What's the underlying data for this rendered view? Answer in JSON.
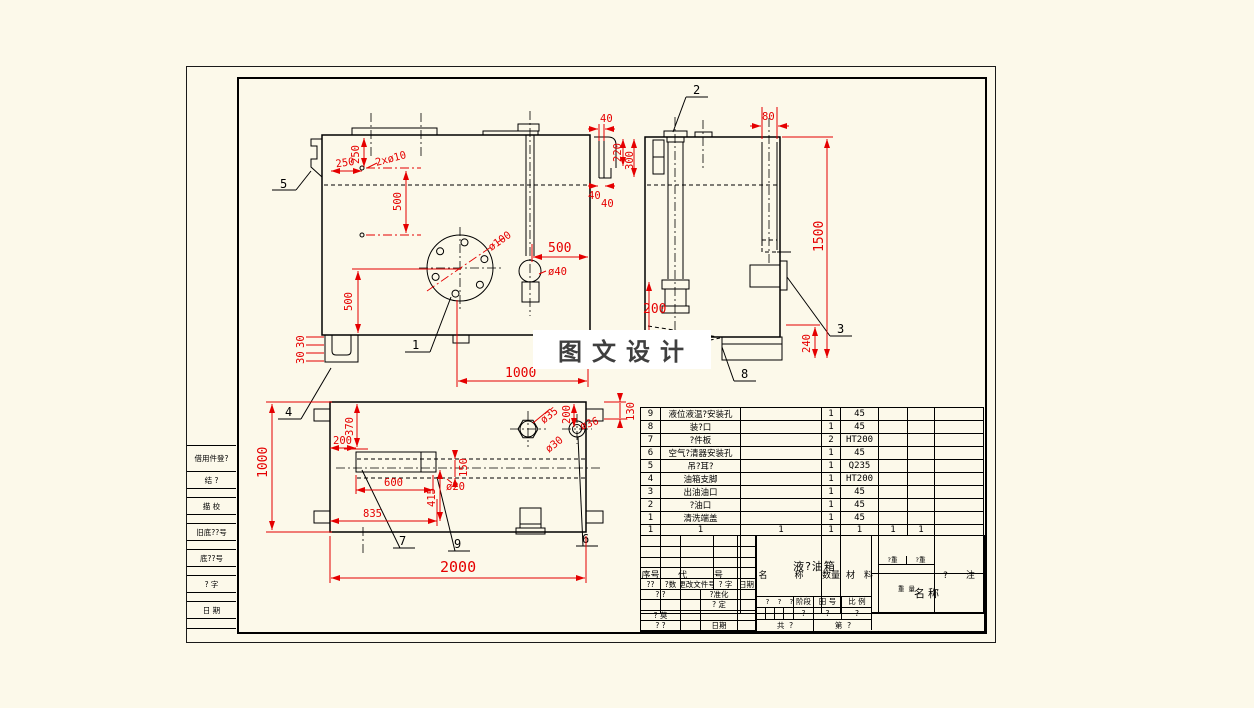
{
  "watermark": {
    "text": "图 文 设 计"
  },
  "left_strip": {
    "rows": [
      {
        "label": "借用件登?"
      },
      {
        "label": "结    ?"
      },
      {
        "label": ""
      },
      {
        "label": "描    校"
      },
      {
        "label": ""
      },
      {
        "label": "旧底??号"
      },
      {
        "label": ""
      },
      {
        "label": "底??号"
      },
      {
        "label": ""
      },
      {
        "label": "?    字"
      },
      {
        "label": ""
      },
      {
        "label": "日    期"
      },
      {
        "label": ""
      }
    ]
  },
  "balloons": {
    "b1": "1",
    "b2": "2",
    "b3": "3",
    "b4": "4",
    "b5": "5",
    "b6": "6",
    "b7": "7",
    "b8": "8",
    "b9": "9"
  },
  "dims": {
    "fv_250h": "250",
    "fv_250v": "250",
    "fv_2x10": "2xø10",
    "fv_500t": "500",
    "fv_500l": "500",
    "fv_30a": "30",
    "fv_30b": "30",
    "fv_d100": "ø100",
    "fv_500h": "500",
    "fv_d40": "ø40",
    "fv_1000": "1000",
    "md_40t": "40",
    "md_220": "220",
    "md_300": "300",
    "md_40a": "40",
    "md_40b": "40",
    "sv_80": "80",
    "sv_1500": "1500",
    "sv_200": "200",
    "sv_240": "240",
    "pv_1000": "1000",
    "pv_370": "370",
    "pv_200": "200",
    "pv_150": "150",
    "pv_d20": "ø20",
    "pv_600": "600",
    "pv_415": "415",
    "pv_835": "835",
    "pv_d35": "ø35",
    "pv_d30": "ø30",
    "pv_200b": "200",
    "pv_d36": "ø36",
    "pv_130": "130",
    "pv_2000": "2000"
  },
  "parts_list": {
    "rows": [
      {
        "no": "9",
        "name": "液位液温?安装孔",
        "qty": "1",
        "material": "45"
      },
      {
        "no": "8",
        "name": "装?口",
        "qty": "1",
        "material": "45"
      },
      {
        "no": "7",
        "name": "?件板",
        "qty": "2",
        "material": "HT200"
      },
      {
        "no": "6",
        "name": "空气?清器安装孔",
        "qty": "1",
        "material": "45"
      },
      {
        "no": "5",
        "name": "吊?耳?",
        "qty": "1",
        "material": "Q235"
      },
      {
        "no": "4",
        "name": "油箱支脚",
        "qty": "1",
        "material": "HT200"
      },
      {
        "no": "3",
        "name": "出油油口",
        "qty": "1",
        "material": "45"
      },
      {
        "no": "2",
        "name": "?油口",
        "qty": "1",
        "material": "45"
      },
      {
        "no": "1",
        "name": "清洗端盖",
        "qty": "1",
        "material": "45"
      }
    ],
    "ones": [
      "1",
      "1",
      "1",
      "1",
      "1",
      "1",
      "1"
    ],
    "header": {
      "no": "序号",
      "code": "代　　　号",
      "name": "名　　　称",
      "qty": "数量",
      "material": "材　料",
      "w1_top": "?重",
      "w2_top": "?重",
      "w_bot": "重  量",
      "notes": "?　　注"
    }
  },
  "title_block": {
    "product": "液?油箱",
    "name_label": "名称",
    "sig_row": [
      "??",
      "?数",
      "更改文件号",
      "? 字",
      "日期"
    ],
    "rows_left": [
      [
        "? ?",
        "",
        "?准化",
        ""
      ],
      [
        "",
        "",
        "? 定",
        ""
      ],
      [
        "? 莫",
        "",
        "",
        ""
      ],
      [
        "? ?",
        "",
        "日期",
        ""
      ]
    ],
    "stage_cells": [
      "?",
      "?",
      "?",
      "?"
    ],
    "phase_label": "阶段",
    "fig_label": "田 号",
    "scale_label": "比 例",
    "phase_val": "?",
    "fig_val": "?",
    "scale_val": "?",
    "sheets_total": "共  ?",
    "sheet_no": "第  ?"
  }
}
